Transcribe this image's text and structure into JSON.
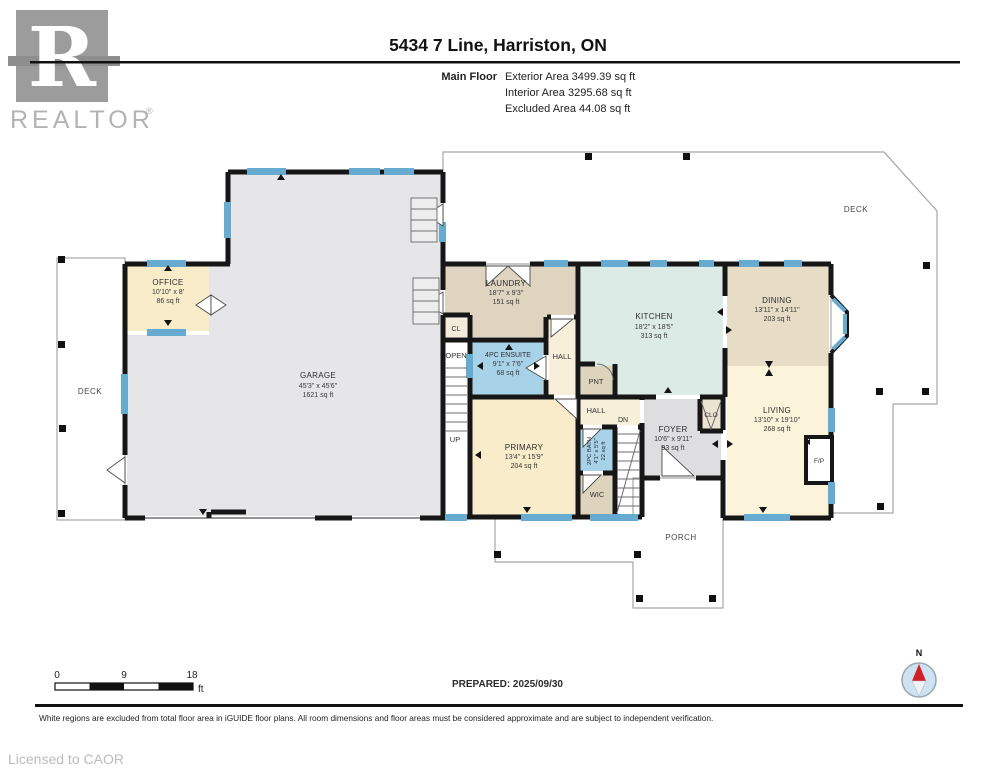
{
  "header": {
    "logo_letter": "R",
    "logo_text": "REALTOR",
    "logo_reg": "®",
    "title": "5434 7 Line, Harriston, ON",
    "floor_label": "Main Floor",
    "exterior_area": "Exterior Area 3499.39 sq ft",
    "interior_area": "Interior Area 3295.68 sq ft",
    "excluded_area": "Excluded Area 44.08 sq ft"
  },
  "plan": {
    "rooms": {
      "garage": {
        "name": "GARAGE",
        "dims": "45'3\" x 45'6\"",
        "area": "1621 sq ft"
      },
      "office": {
        "name": "OFFICE",
        "dims": "10'10\" x 8'",
        "area": "86 sq ft"
      },
      "laundry": {
        "name": "LAUNDRY",
        "dims": "18'7\" x 9'3\"",
        "area": "151 sq ft"
      },
      "ensuite": {
        "name": "4PC ENSUITE",
        "dims": "9'1\" x 7'6\"",
        "area": "68 sq ft"
      },
      "kitchen": {
        "name": "KITCHEN",
        "dims": "18'2\" x 18'5\"",
        "area": "313 sq ft"
      },
      "dining": {
        "name": "DINING",
        "dims": "13'11\" x 14'11\"",
        "area": "203 sq ft"
      },
      "living": {
        "name": "LIVING",
        "dims": "13'10\" x 19'10\"",
        "area": "268 sq ft"
      },
      "primary": {
        "name": "PRIMARY",
        "dims": "13'4\" x 15'9\"",
        "area": "204 sq ft"
      },
      "foyer": {
        "name": "FOYER",
        "dims": "10'6\" x 9'11\"",
        "area": "93 sq ft"
      },
      "bath2pc": {
        "name": "2PC BATH",
        "dims": "4'1\" x 5'5\"",
        "area": "22 sq ft"
      }
    },
    "labels": {
      "deck_left": "DECK",
      "deck_right": "DECK",
      "porch": "PORCH",
      "open": "OPEN",
      "up": "UP",
      "dn": "DN",
      "cl": "CL",
      "clo": "CLO",
      "pnt": "PNT",
      "wic": "WIC",
      "hall_upper": "HALL",
      "hall_lower": "HALL",
      "fireplace": "F/P"
    }
  },
  "footer": {
    "scale": {
      "tick0": "0",
      "tick9": "9",
      "tick18": "18",
      "unit": "ft"
    },
    "prepared": "PREPARED: 2025/09/30",
    "disclaimer": "White regions are excluded from total floor area in iGUIDE floor plans. All room dimensions and floor areas must be considered approximate and are subject to independent verification.",
    "licensed": "Licensed to CAOR",
    "compass_n": "N"
  },
  "colors": {
    "window": "#68abd0",
    "wall": "#161616",
    "garage_fill": "#e6e6e8",
    "wet_room_fill": "#a7d2e8",
    "kitchen_fill": "#dcebe5",
    "compass_needle": "#d22027"
  }
}
